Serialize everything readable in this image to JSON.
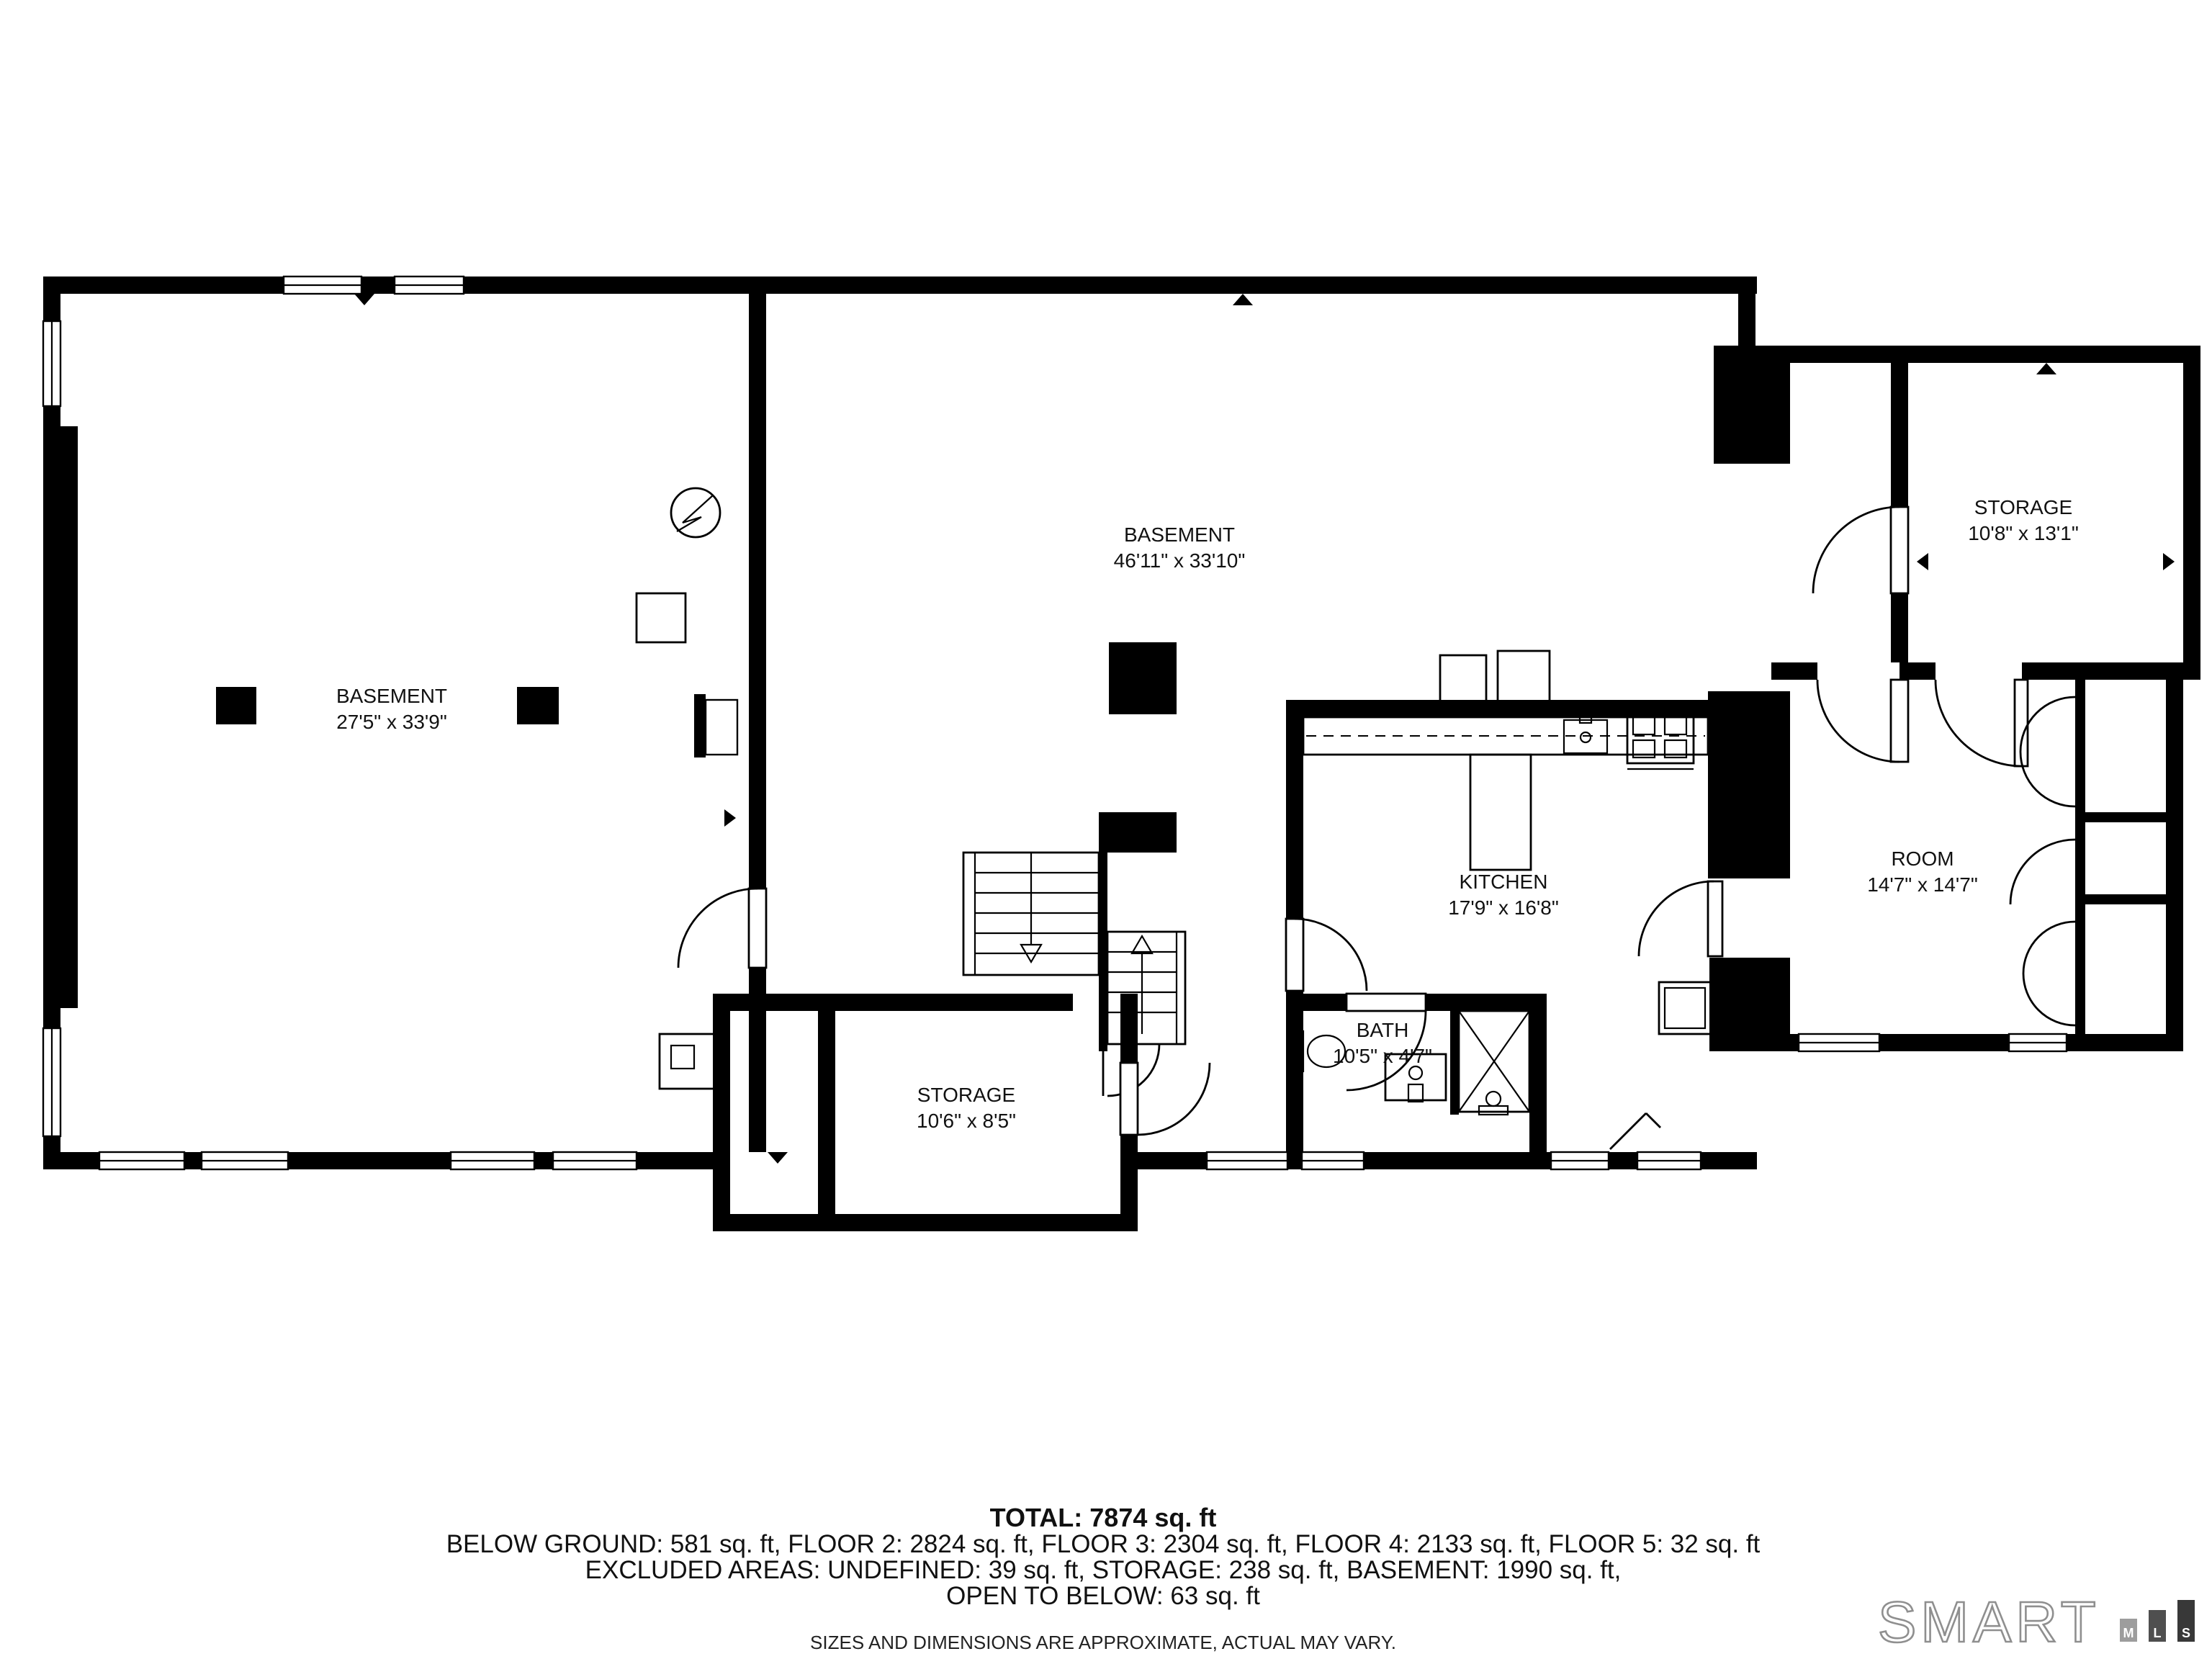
{
  "rooms": [
    {
      "name": "BASEMENT",
      "dims": "27'5\" x 33'9\""
    },
    {
      "name": "BASEMENT",
      "dims": "46'11\" x 33'10\""
    },
    {
      "name": "STORAGE",
      "dims": "10'8\" x 13'1\""
    },
    {
      "name": "ROOM",
      "dims": "14'7\" x 14'7\""
    },
    {
      "name": "KITCHEN",
      "dims": "17'9\" x 16'8\""
    },
    {
      "name": "BATH",
      "dims": "10'5\" x 4'7\""
    },
    {
      "name": "STORAGE",
      "dims": "10'6\" x 8'5\""
    }
  ],
  "summary": {
    "total": "TOTAL: 7874 sq. ft",
    "floors": "BELOW GROUND: 581 sq. ft, FLOOR 2: 2824 sq. ft, FLOOR 3: 2304 sq. ft, FLOOR 4: 2133 sq. ft, FLOOR 5: 32 sq. ft",
    "excluded": "EXCLUDED AREAS: UNDEFINED: 39 sq. ft, STORAGE: 238 sq. ft, BASEMENT: 1990 sq. ft,",
    "open_below": "OPEN TO BELOW: 63 sq. ft",
    "disclaimer": "SIZES AND DIMENSIONS ARE APPROXIMATE, ACTUAL MAY VARY."
  },
  "logo": {
    "brand": "SMART",
    "bars": [
      {
        "label": "M",
        "color": "#9d9d9d"
      },
      {
        "label": "L",
        "color": "#4f4f4f"
      },
      {
        "label": "S",
        "color": "#383838"
      }
    ]
  },
  "colors": {
    "wall": "#000000",
    "background": "#ffffff",
    "logo_outline": "#8f8f8f"
  }
}
